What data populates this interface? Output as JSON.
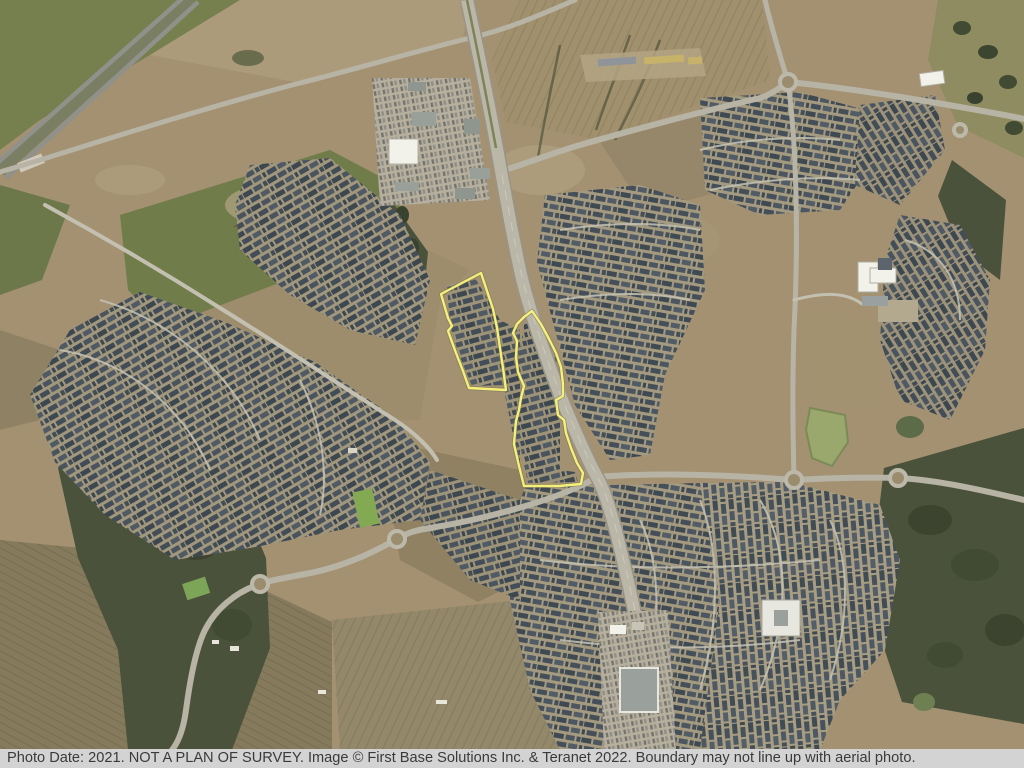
{
  "caption": {
    "text": "Photo Date: 2021. NOT A PLAN OF SURVEY. Image © First Base Solutions Inc. & Teranet 2022. Boundary may not line up with aerial photo.",
    "background": "#d3d3d3",
    "text_color": "#3a3a3a"
  },
  "map": {
    "kind": "aerial-photo",
    "boundary": {
      "color": "#f5ef7c",
      "parcels": [
        {
          "name": "west-parcel",
          "points": "481,273 441,294 448,318 452,326 448,331 456,353 463,371 469,388 506,390 503,368 500,348 497,328 493,309 487,291"
        },
        {
          "name": "east-parcel",
          "points": "532,311 541,324 549,339 556,353 561,367 563,384 563,396 556,400 558,415 564,420 566,433 571,448 577,463 583,473 581,484 559,486 524,486 519,466 514,444 516,421 519,410 521,398 524,386 518,372 516,357 517,341 513,333 517,324 524,317"
        }
      ]
    },
    "palette": {
      "ground": "#a39172",
      "field_green": "#75804e",
      "forest": "#4b523b",
      "road": "#b7b4a6",
      "pond": "#9aa86d",
      "buildings_white": "#f2f1ea",
      "houses_dark": "#424c55"
    }
  }
}
